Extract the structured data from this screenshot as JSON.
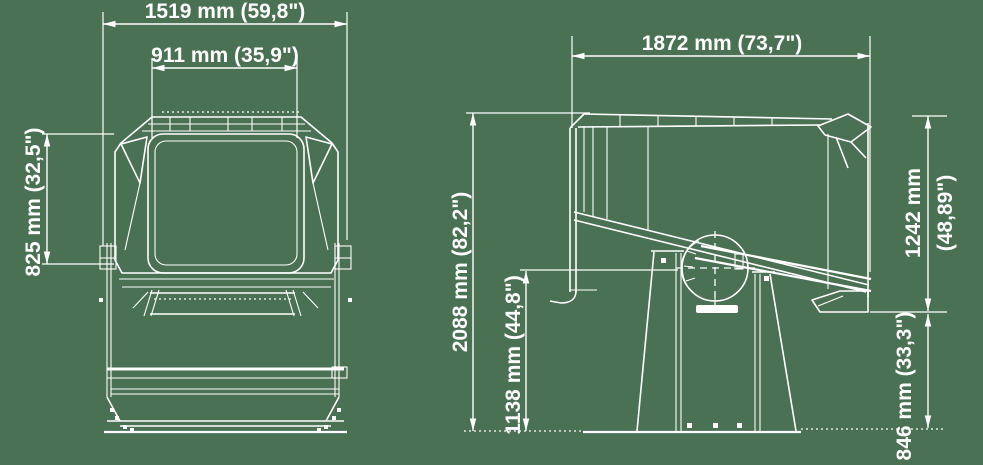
{
  "drawing": {
    "title": "searchlight-dimension-drawing",
    "colors": {
      "background": "#4a7153",
      "line": "#ffffff"
    },
    "views": {
      "front": "front-view",
      "side": "side-view"
    },
    "dimensions": {
      "front_overall_width": "1519 mm (59,8\")",
      "front_window_width": "911 mm (35,9\")",
      "front_window_height": "825 mm (32,5\")",
      "side_overall_length": "1872 mm (73,7\")",
      "side_overall_height": "2088 mm (82,2\")",
      "side_axis_height": "1138 mm (44,8\")",
      "side_head_height_mm": "1242 mm",
      "side_head_height_in": "(48,89\")",
      "side_underside_height": "846 mm (33,3\")"
    }
  }
}
